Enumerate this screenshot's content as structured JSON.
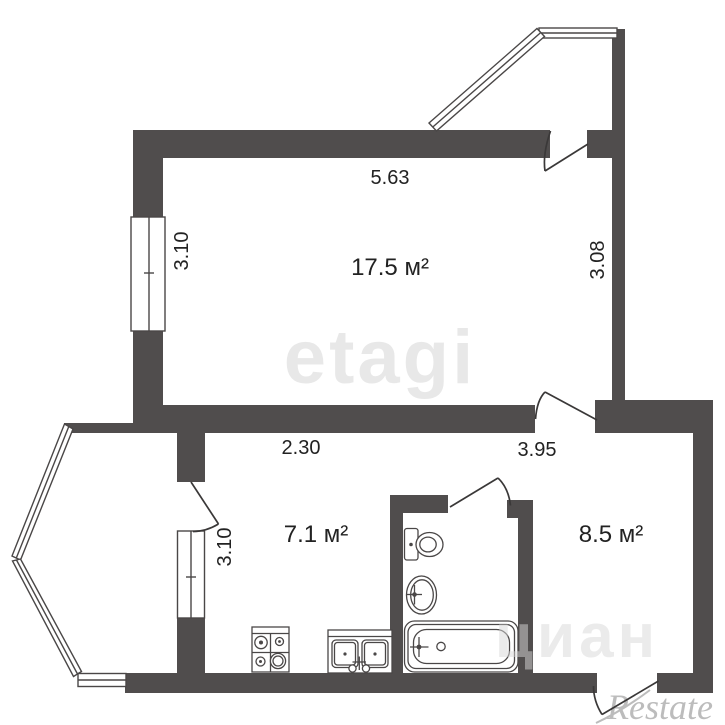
{
  "floorplan": {
    "rooms": [
      {
        "name": "living-room",
        "area": "17.5 м²"
      },
      {
        "name": "kitchen",
        "area": "7.1 м²"
      },
      {
        "name": "hallway",
        "area": "8.5 м²"
      }
    ],
    "dimensions": {
      "top": "5.63",
      "left": "3.10",
      "right": "3.08",
      "middle_left": "2.30",
      "middle_right": "3.95",
      "balcony": "3.10"
    },
    "watermarks": {
      "center": "etagi",
      "right": "циан",
      "bottom_right": "Restate"
    },
    "colors": {
      "wall": "#504d4d",
      "outline": "#4a4747",
      "text": "#222222"
    }
  }
}
